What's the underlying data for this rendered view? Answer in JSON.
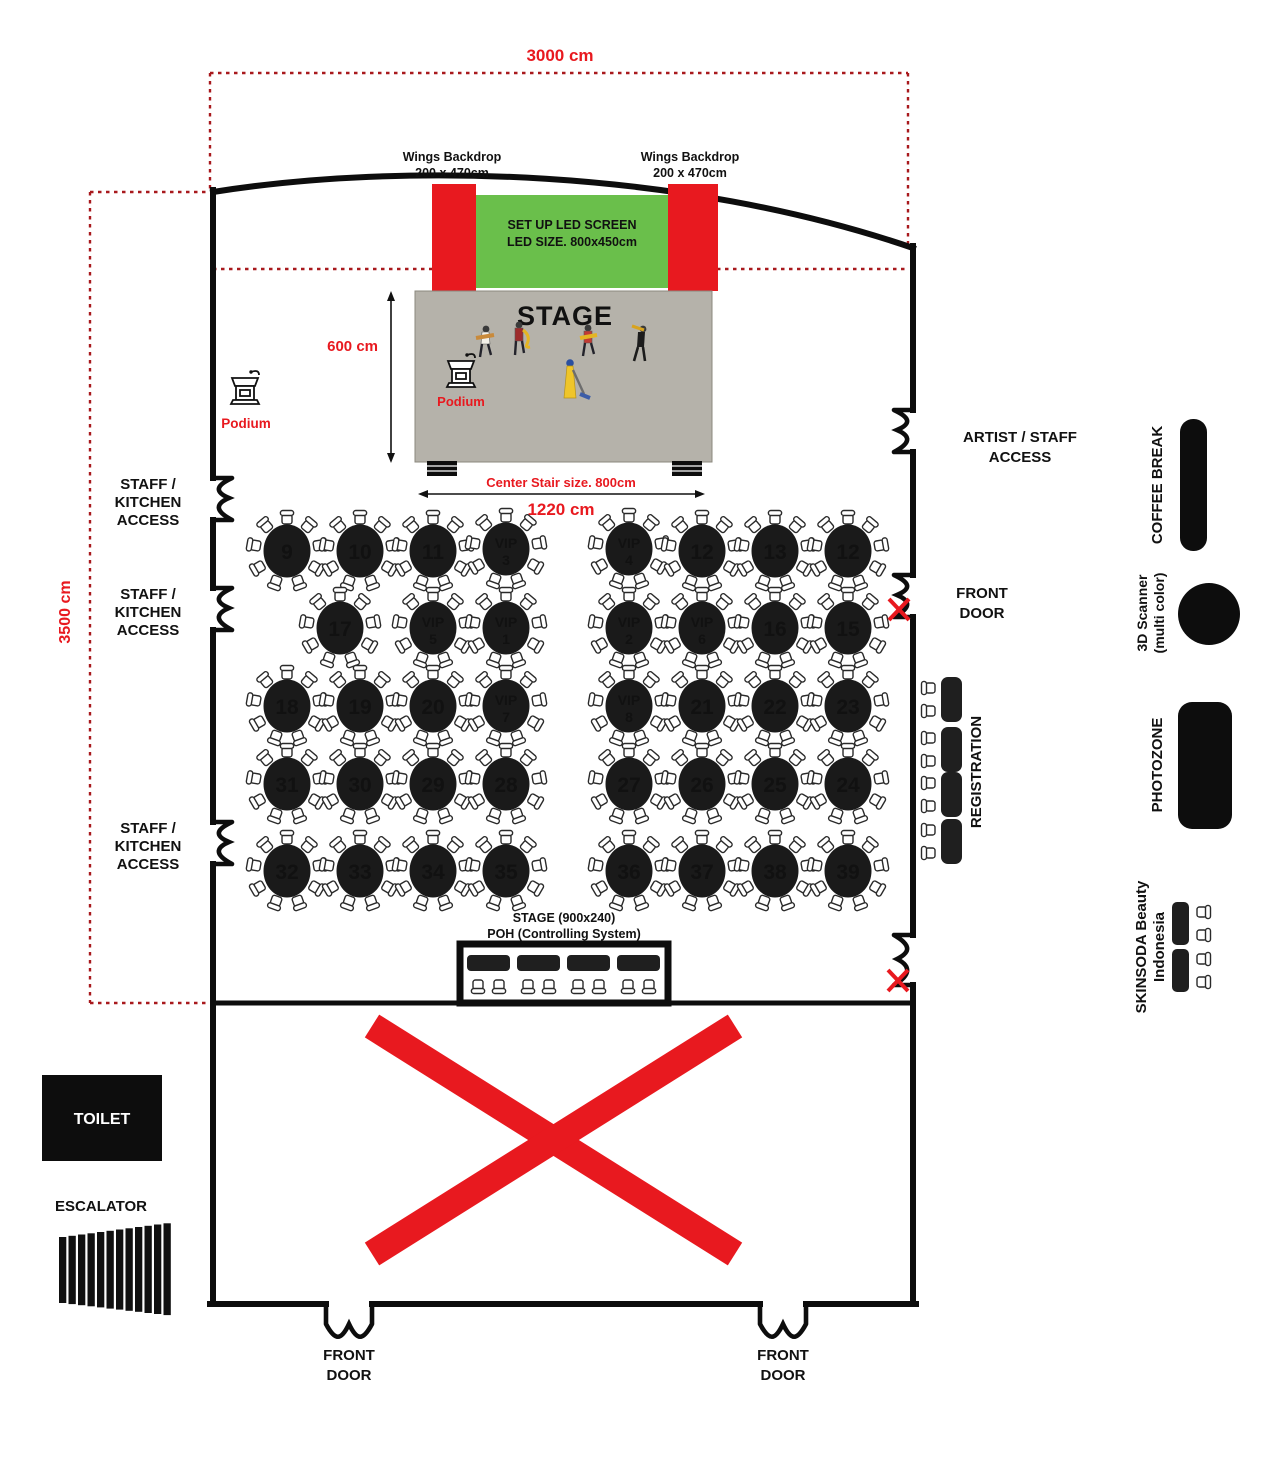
{
  "measurements": {
    "top_width": "3000 cm",
    "left_height": "3500 cm",
    "stage_depth": "600 cm",
    "stage_width": "1220 cm",
    "stair": "Center Stair size. 800cm"
  },
  "stage": {
    "title": "STAGE",
    "led_line1": "SET UP LED SCREEN",
    "led_line2": "LED SIZE. 800x450cm",
    "wing_line1": "Wings Backdrop",
    "wing_line2": "200 x 470cm",
    "podium": "Podium"
  },
  "labels": {
    "staff_kitchen": [
      "STAFF /",
      "KITCHEN",
      "ACCESS"
    ],
    "artist_access": [
      "ARTIST / STAFF",
      "ACCESS"
    ],
    "front_door": [
      "FRONT",
      "DOOR"
    ],
    "registration": "REGISTRATION",
    "coffee_break": "COFFEE BREAK",
    "scanner_line1": "3D Scanner",
    "scanner_line2": "(multi color)",
    "photozone": "PHOTOZONE",
    "skinsoda_line1": "SKINSODA Beauty",
    "skinsoda_line2": "Indonesia",
    "toilet": "TOILET",
    "escalator": "ESCALATOR",
    "poh_line1": "STAGE (900x240)",
    "poh_line2": "POH (Controlling System)"
  },
  "colors": {
    "accent_red": "#e8191f",
    "dashed_red": "#a8191d",
    "led_green": "#6abf4b",
    "stage_gray": "#b5b2aa",
    "black": "#111111"
  },
  "tables": [
    {
      "label": "9",
      "x": 287,
      "y": 551
    },
    {
      "label": "10",
      "x": 360,
      "y": 551
    },
    {
      "label": "11",
      "x": 433,
      "y": 551
    },
    {
      "label": "VIP",
      "sub": "3",
      "x": 506,
      "y": 549
    },
    {
      "label": "VIP",
      "sub": "4",
      "x": 629,
      "y": 549
    },
    {
      "label": "12",
      "x": 702,
      "y": 551
    },
    {
      "label": "13",
      "x": 775,
      "y": 551
    },
    {
      "label": "12",
      "x": 848,
      "y": 551
    },
    {
      "label": "17",
      "x": 340,
      "y": 628
    },
    {
      "label": "VIP",
      "sub": "5",
      "x": 433,
      "y": 628
    },
    {
      "label": "VIP",
      "sub": "1",
      "x": 506,
      "y": 628
    },
    {
      "label": "VIP",
      "sub": "2",
      "x": 629,
      "y": 628
    },
    {
      "label": "VIP",
      "sub": "6",
      "x": 702,
      "y": 628
    },
    {
      "label": "16",
      "x": 775,
      "y": 628
    },
    {
      "label": "15",
      "x": 848,
      "y": 628
    },
    {
      "label": "18",
      "x": 287,
      "y": 706
    },
    {
      "label": "19",
      "x": 360,
      "y": 706
    },
    {
      "label": "20",
      "x": 433,
      "y": 706
    },
    {
      "label": "VIP",
      "sub": "7",
      "x": 506,
      "y": 706
    },
    {
      "label": "VIP",
      "sub": "8",
      "x": 629,
      "y": 706
    },
    {
      "label": "21",
      "x": 702,
      "y": 706
    },
    {
      "label": "22",
      "x": 775,
      "y": 706
    },
    {
      "label": "23",
      "x": 848,
      "y": 706
    },
    {
      "label": "31",
      "x": 287,
      "y": 784
    },
    {
      "label": "30",
      "x": 360,
      "y": 784
    },
    {
      "label": "29",
      "x": 433,
      "y": 784
    },
    {
      "label": "28",
      "x": 506,
      "y": 784
    },
    {
      "label": "27",
      "x": 629,
      "y": 784
    },
    {
      "label": "26",
      "x": 702,
      "y": 784
    },
    {
      "label": "25",
      "x": 775,
      "y": 784
    },
    {
      "label": "24",
      "x": 848,
      "y": 784
    },
    {
      "label": "32",
      "x": 287,
      "y": 871
    },
    {
      "label": "33",
      "x": 360,
      "y": 871
    },
    {
      "label": "34",
      "x": 433,
      "y": 871
    },
    {
      "label": "35",
      "x": 506,
      "y": 871
    },
    {
      "label": "36",
      "x": 629,
      "y": 871
    },
    {
      "label": "37",
      "x": 702,
      "y": 871
    },
    {
      "label": "38",
      "x": 775,
      "y": 871
    },
    {
      "label": "39",
      "x": 848,
      "y": 871
    }
  ],
  "furniture": {
    "registration_desk_count": 4,
    "poh_desk_count": 4,
    "skinsoda_desk_count": 2,
    "chairs_per_round_table": 9
  }
}
